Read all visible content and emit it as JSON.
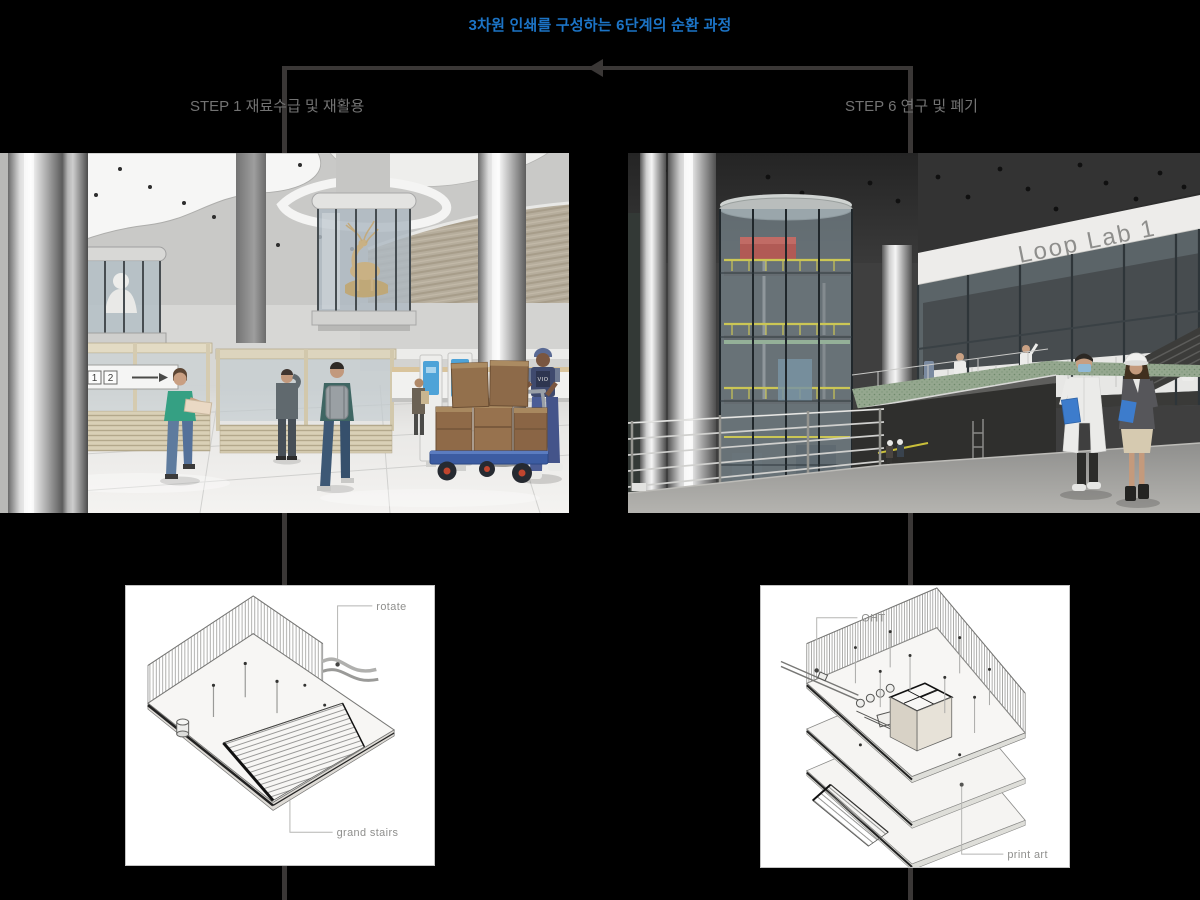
{
  "background": "#000000",
  "title": {
    "text": "3차원 인쇄를 구성하는 6단계의 순환 과정",
    "color": "#1c74c6"
  },
  "connector": {
    "color": "#3a3736",
    "arrow_direction": "left"
  },
  "steps": {
    "left_label": "STEP 1 재료수급 및 재활용",
    "right_label": "STEP 6 연구 및 폐기",
    "color": "#737373"
  },
  "photo_left": {
    "sign_number_1": "1",
    "sign_number_2": "2",
    "worker_vest_text": "VIO"
  },
  "photo_right": {
    "wall_sign": "Loop Lab 1"
  },
  "diagram_left": {
    "label_rotate": "rotate",
    "label_grand_stairs": "grand stairs"
  },
  "diagram_right": {
    "label_oht": "OHT",
    "label_print_art": "print art"
  }
}
